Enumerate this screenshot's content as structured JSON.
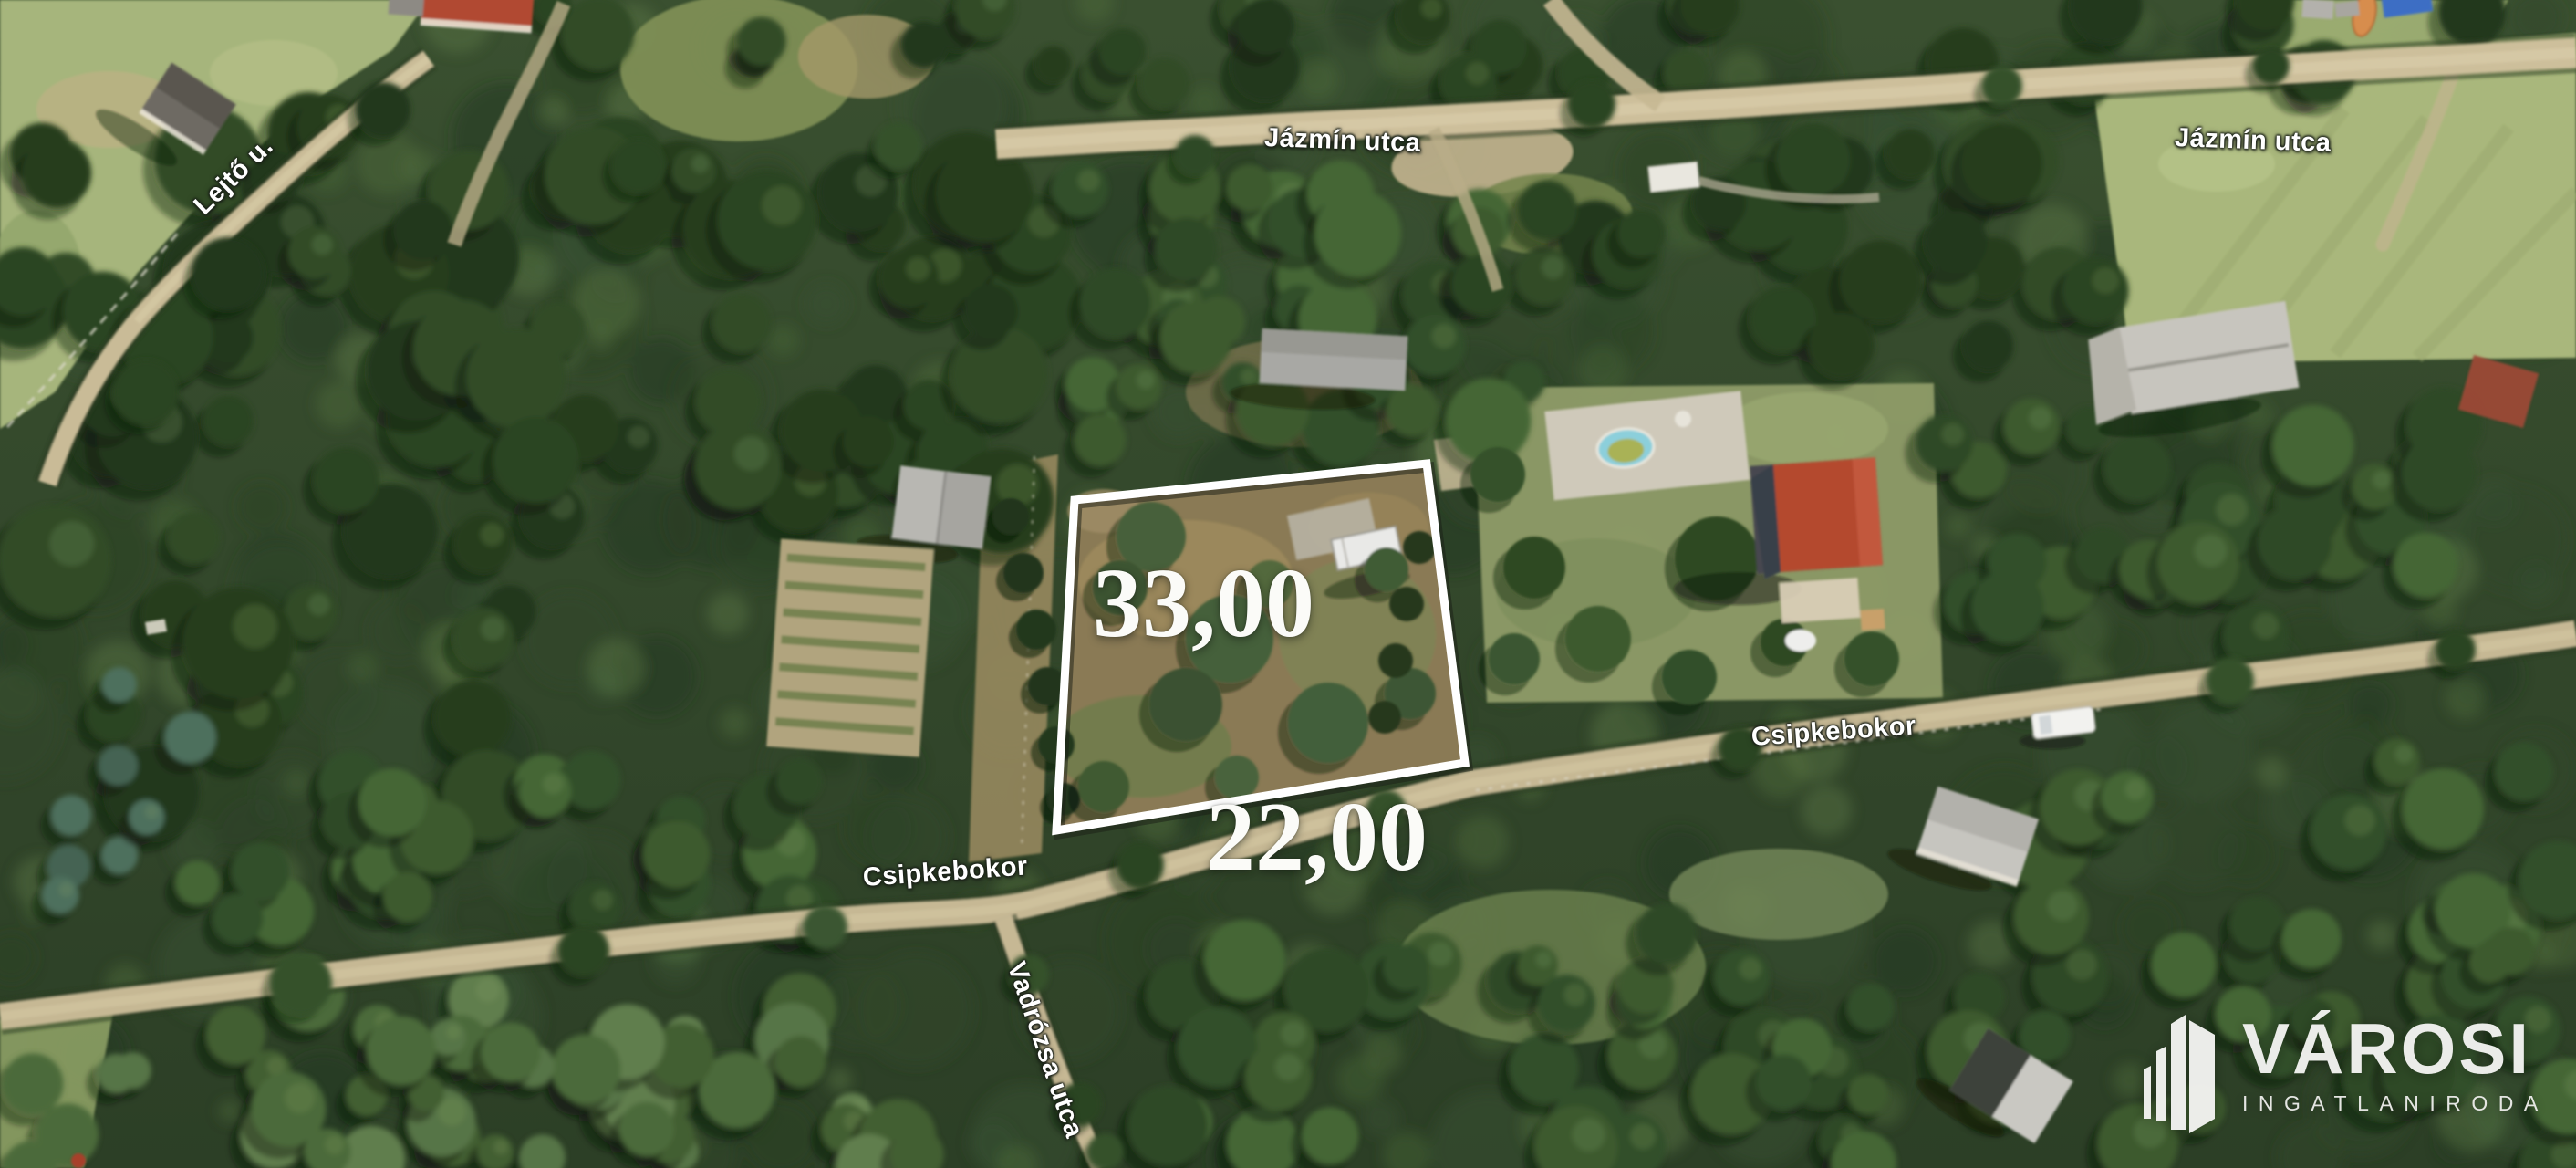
{
  "streets": {
    "lejto": "Lejtő u.",
    "jazmin_top": "Jázmín utca",
    "jazmin_right": "Jázmín utca",
    "csipkebokor_left": "Csipkebokor",
    "csipkebokor_right": "Csipkebokor",
    "vadrozsa": "Vadrózsa utca"
  },
  "parcel": {
    "length_label": "33,00",
    "frontage_label": "22,00",
    "outline_color": "#ffffff"
  },
  "watermark": {
    "brand": "VÁROSI",
    "tagline": "INGATLANIRODA",
    "color": "#f2f2f0"
  },
  "palette": {
    "forest": "#2f4a26",
    "road": "#cdbf9b",
    "parcel_ground": "#8a7a54",
    "house_roof": "#b4492f",
    "pool": "#8ccfdb"
  }
}
